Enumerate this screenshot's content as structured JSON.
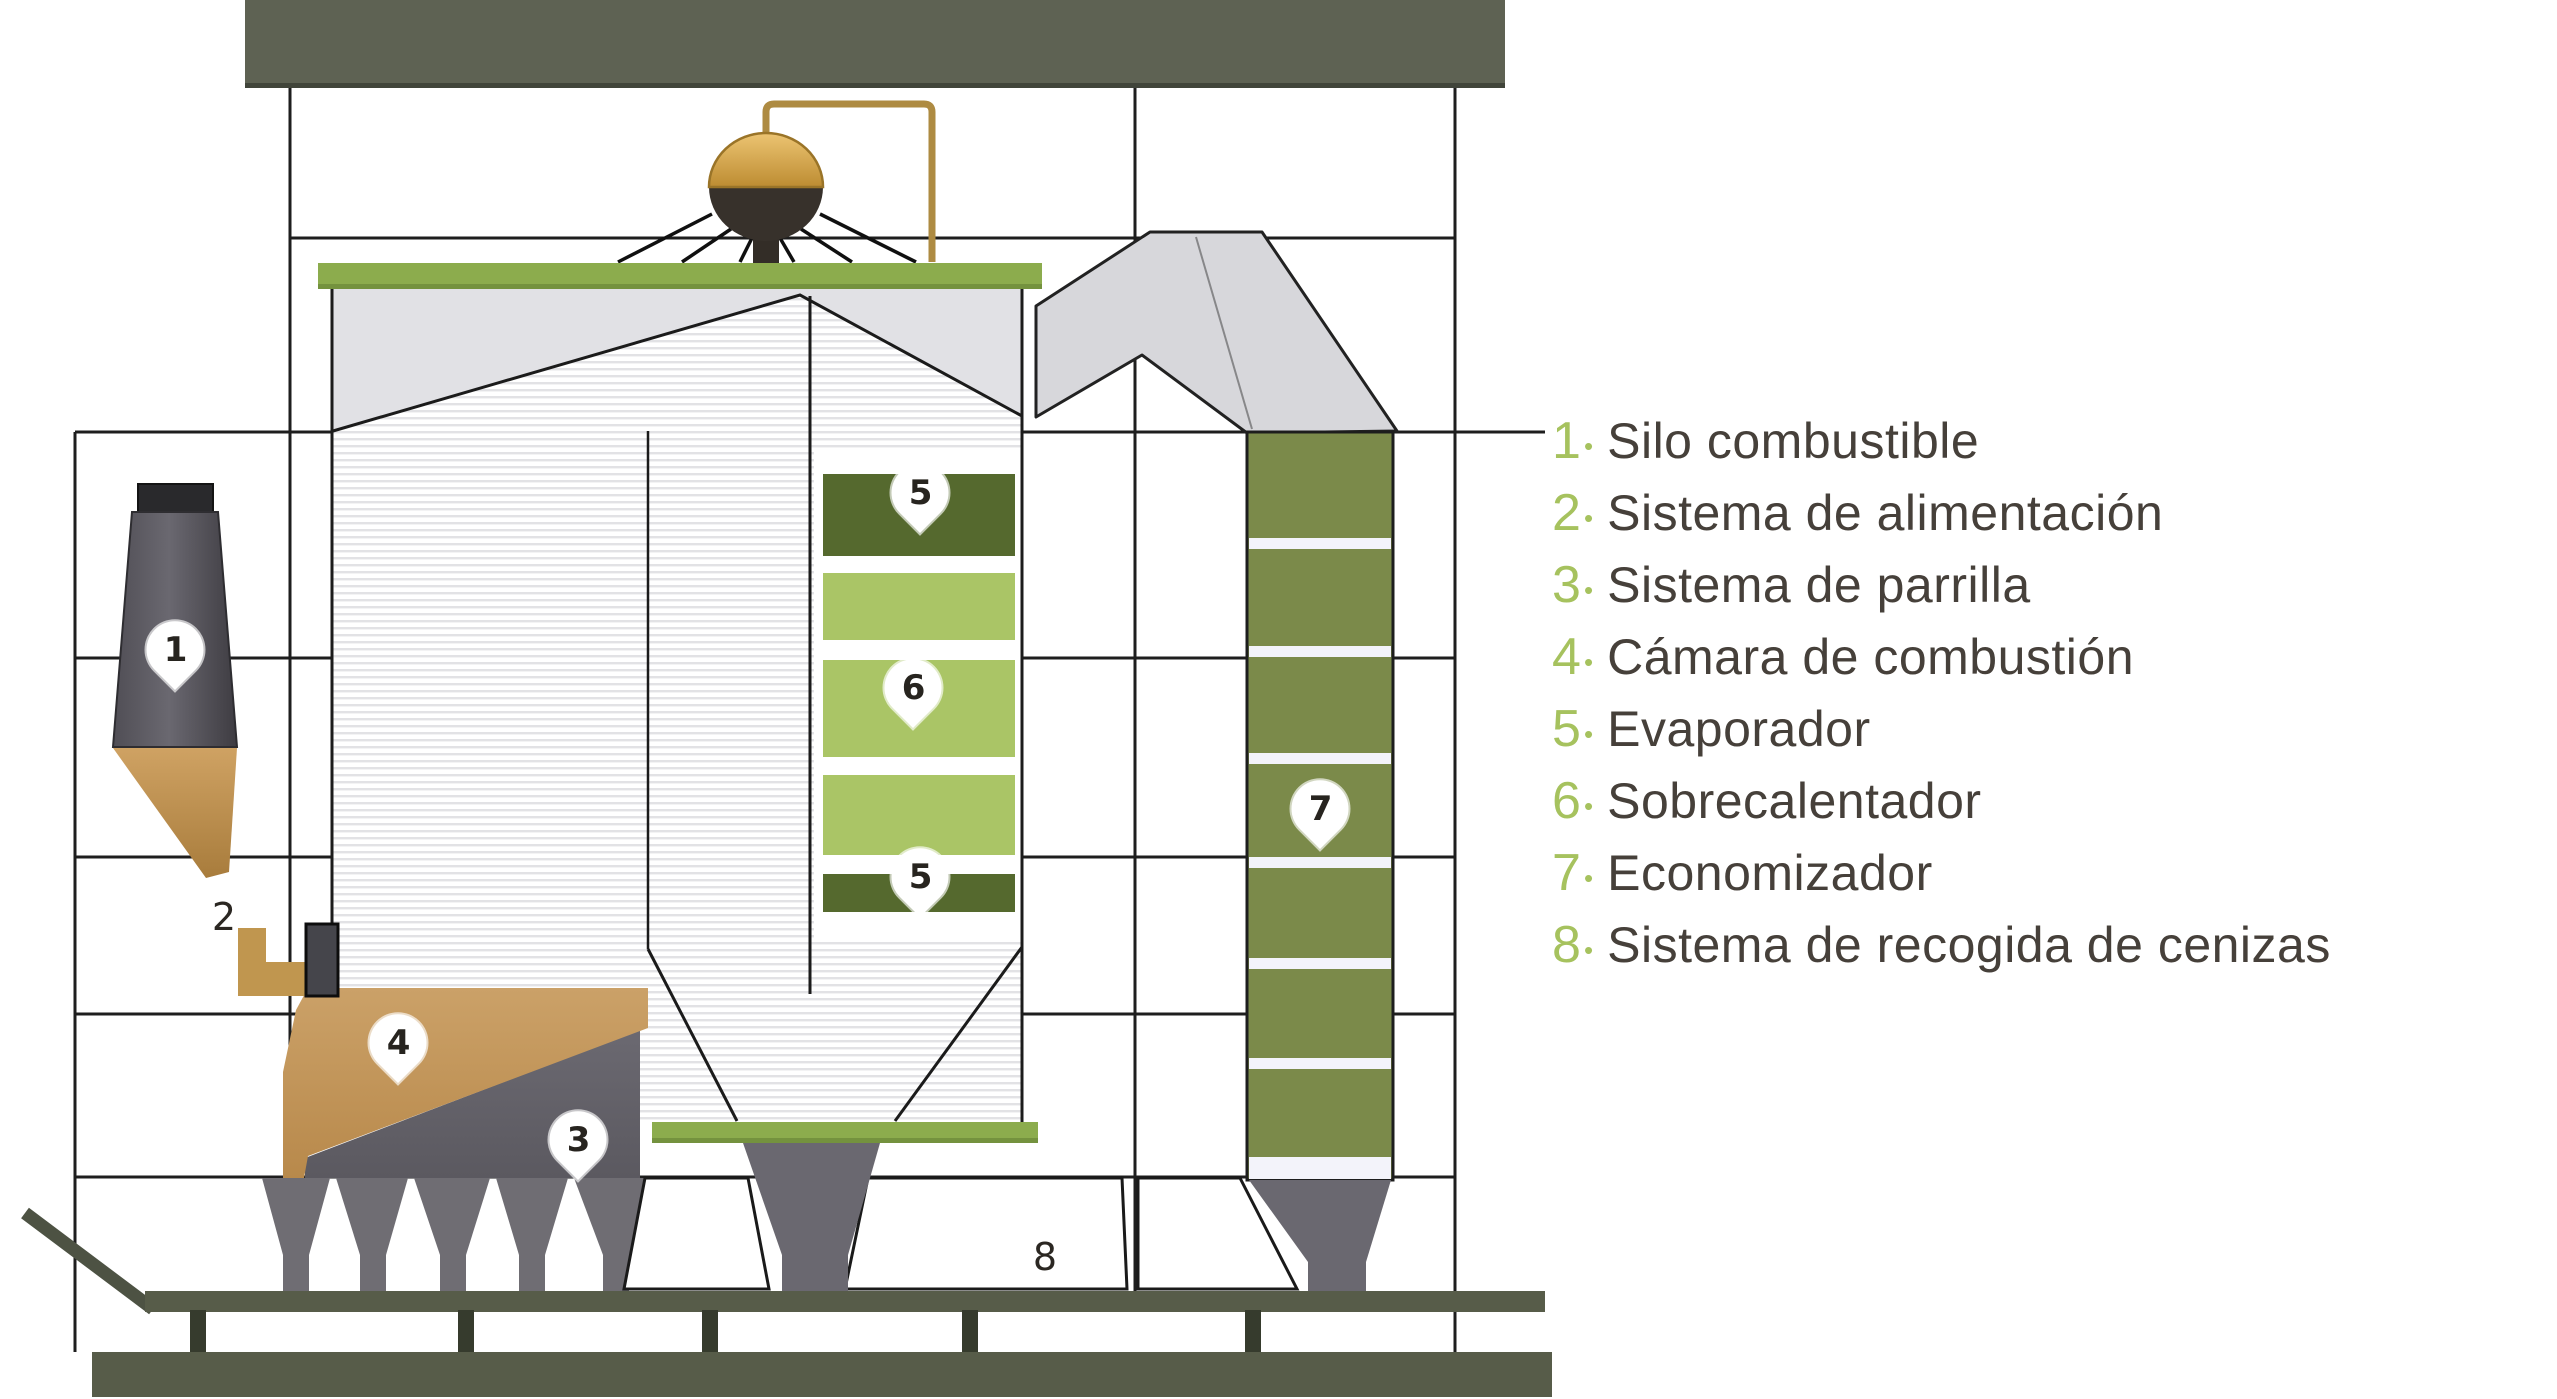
{
  "legend": {
    "bullet": "•",
    "items": [
      {
        "number": "1",
        "label": "Silo combustible"
      },
      {
        "number": "2",
        "label": "Sistema de alimentación"
      },
      {
        "number": "3",
        "label": "Sistema de parrilla"
      },
      {
        "number": "4",
        "label": "Cámara de combustión"
      },
      {
        "number": "5",
        "label": "Evaporador"
      },
      {
        "number": "6",
        "label": "Sobrecalentador"
      },
      {
        "number": "7",
        "label": "Economizador"
      },
      {
        "number": "8",
        "label": "Sistema de recogida de cenizas"
      }
    ]
  },
  "diagram": {
    "markers": {
      "m1": "1",
      "m2": "2",
      "m3": "3",
      "m4": "4",
      "m5_top": "5",
      "m5_bottom": "5",
      "m6": "6",
      "m7": "7",
      "m8": "8"
    }
  },
  "colors": {
    "legend_number_green": "#a6c25e",
    "legend_text": "#46403a",
    "structure_olive": "#5e6253",
    "economizer_olive": "#7b8a4a",
    "block_dark_green": "#55692e",
    "block_light_green": "#aac566",
    "boiler_bar_green": "#8cac4d",
    "fuel_tan": "#c0964f",
    "duct_gray": "#d7d7db",
    "hopper_gray": "#6f6d73",
    "drum_gold": "#d3a24a",
    "drum_brown": "#37312b"
  }
}
